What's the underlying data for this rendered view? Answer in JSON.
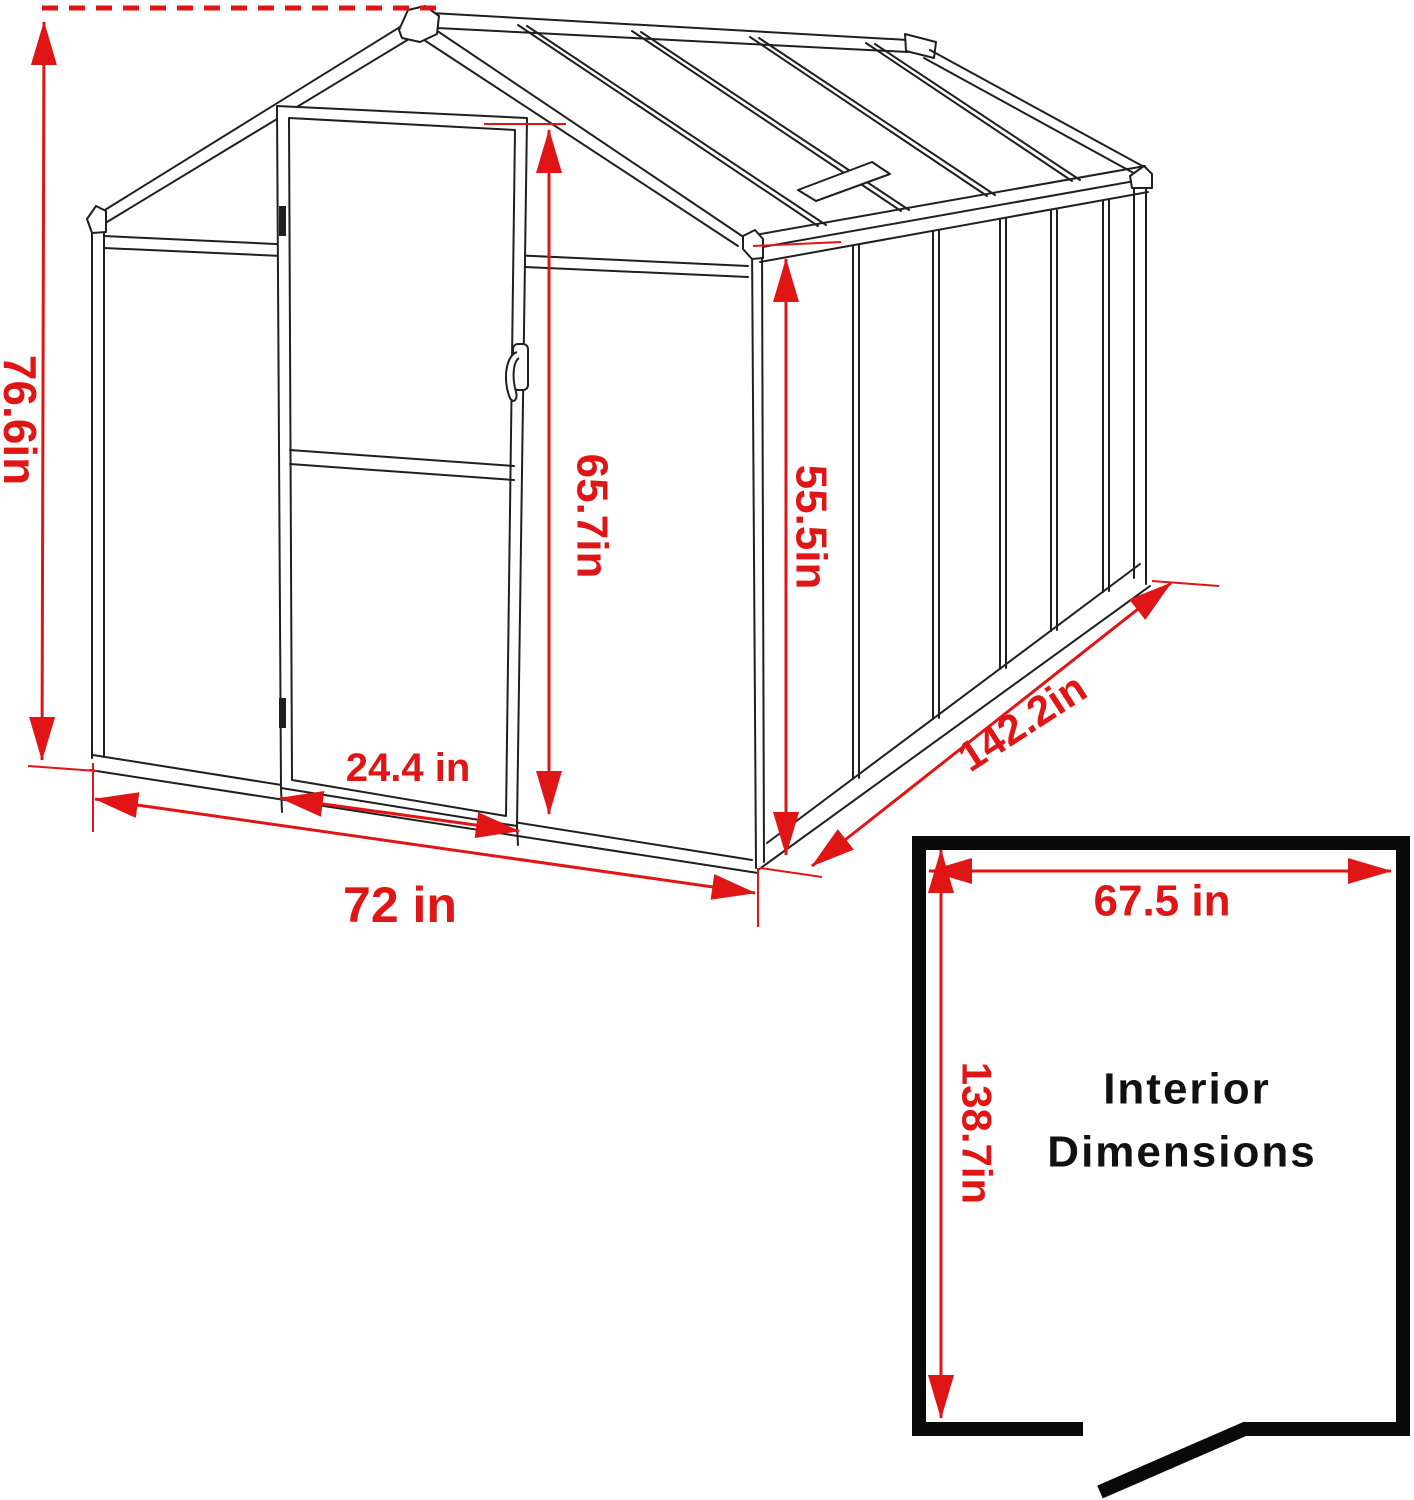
{
  "diagram": {
    "colors": {
      "dimension_red": "#e01616",
      "line_black": "#1f1f1f",
      "plan_black": "#0a0a0a"
    },
    "exterior": {
      "overall_height": "76.6in",
      "front_width": "72 in",
      "door_width": "24.4 in",
      "door_height": "65.7in",
      "side_wall_height": "55.5in",
      "depth": "142.2in"
    },
    "interior": {
      "heading_line1": "Interior",
      "heading_line2": "Dimensions",
      "width": "67.5 in",
      "depth": "138.7in"
    }
  }
}
